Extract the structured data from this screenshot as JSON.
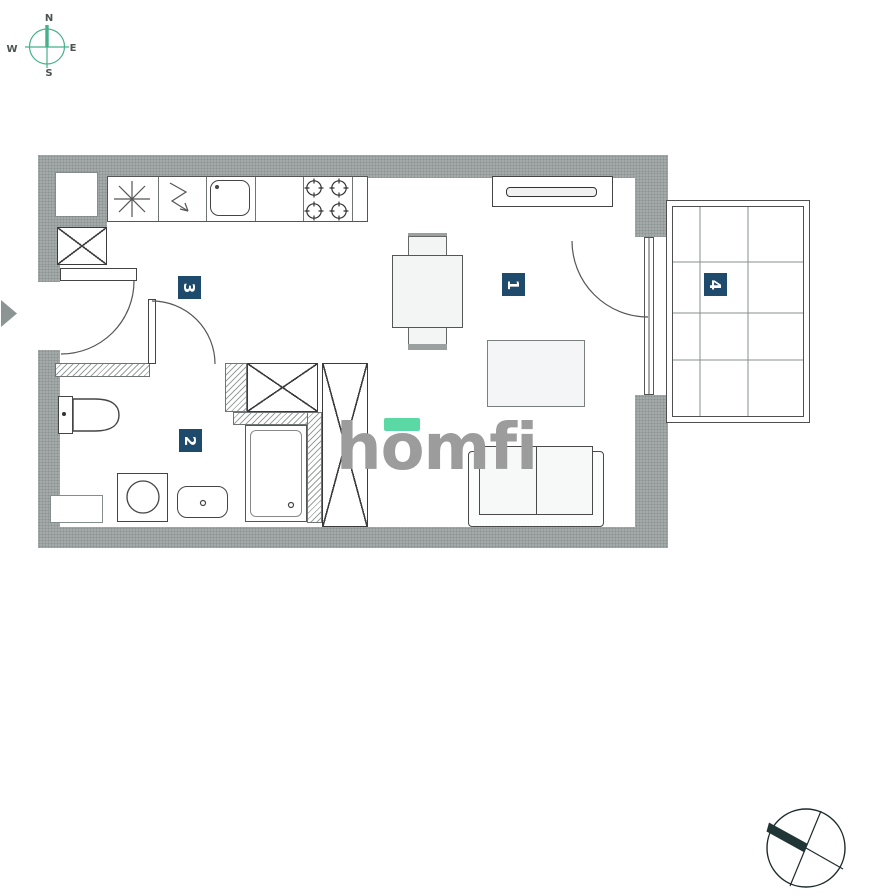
{
  "page": {
    "background": "#ffffff"
  },
  "compass": {
    "labels": {
      "n": "N",
      "e": "E",
      "s": "S",
      "w": "W"
    },
    "line_color": "#43b189",
    "label_color": "#4b5450"
  },
  "watermark": {
    "text": "homfi",
    "text_color": "#9c9c9c",
    "accent_color": "#5bd9a5"
  },
  "plan": {
    "colors": {
      "wall": "#a4a9a9",
      "wall_speckle": "#8b9292",
      "outline": "#4a4a4a",
      "label_bg": "#1e4a6c",
      "label_text": "#ffffff"
    },
    "rooms": [
      {
        "number": "1",
        "name": "living-room"
      },
      {
        "number": "2",
        "name": "bathroom"
      },
      {
        "number": "3",
        "name": "hall-kitchen"
      },
      {
        "number": "4",
        "name": "balcony"
      }
    ],
    "fixtures": [
      "fridge-snowflake",
      "zigzag-appliance-arrow",
      "kitchen-sink",
      "stove-four-burners",
      "tv-sideboard",
      "dining-table",
      "chair",
      "rug",
      "sofa",
      "wardrobe-cross",
      "shaft-cross",
      "toilet",
      "washing-machine",
      "washbasin",
      "shower",
      "balcony-grid",
      "entrance-arrow",
      "surveyor-circle-mark"
    ]
  }
}
